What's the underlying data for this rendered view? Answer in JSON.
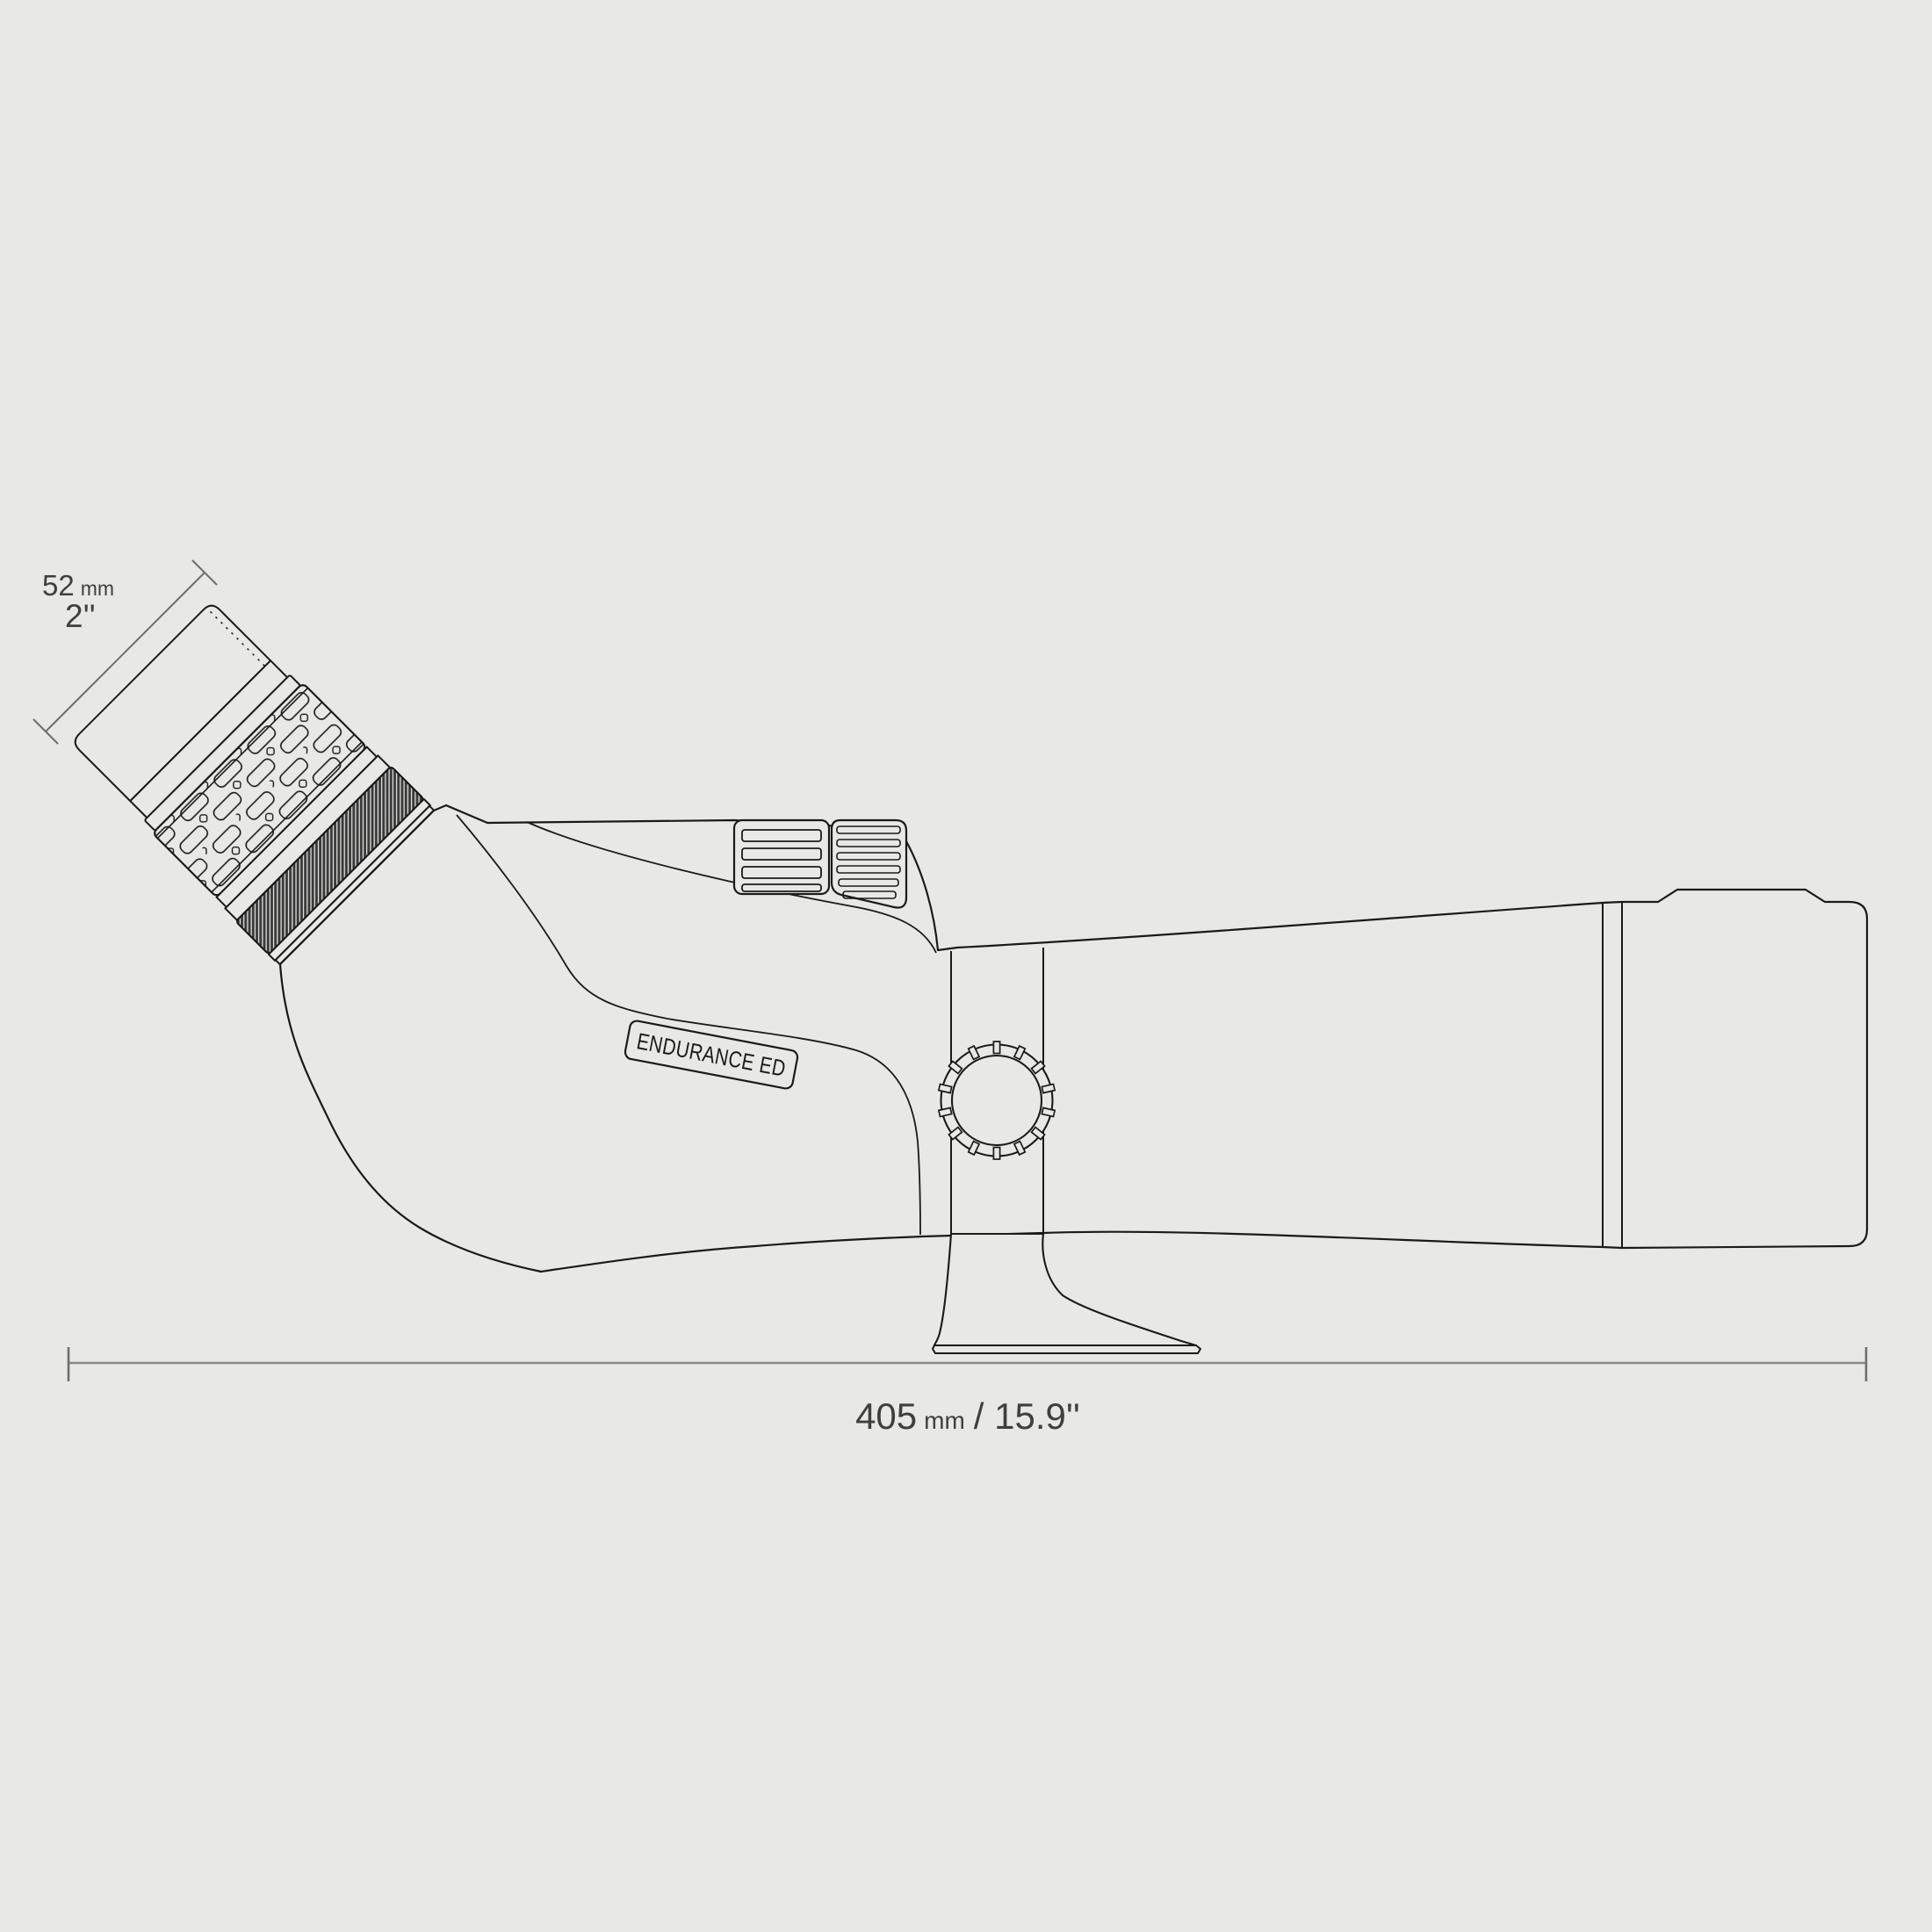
{
  "diagram": {
    "type": "technical-product-drawing",
    "subject": "angled spotting scope side profile",
    "product_label": "ENDURANCE ED",
    "eyepiece_dimension": {
      "value": "52",
      "unit": "mm",
      "inches": "2''"
    },
    "length_dimension": {
      "value": "405",
      "unit": "mm",
      "separator_and_inches": "/ 15.9''"
    },
    "colors": {
      "background": "#e8e8e6",
      "outline": "#1a1a1a",
      "knurl_dark": "#3a3a3a",
      "dimension_line": "#8a8a8a",
      "dimension_tick": "#6e6e6e",
      "dimension_text": "#3f3f3f"
    }
  }
}
